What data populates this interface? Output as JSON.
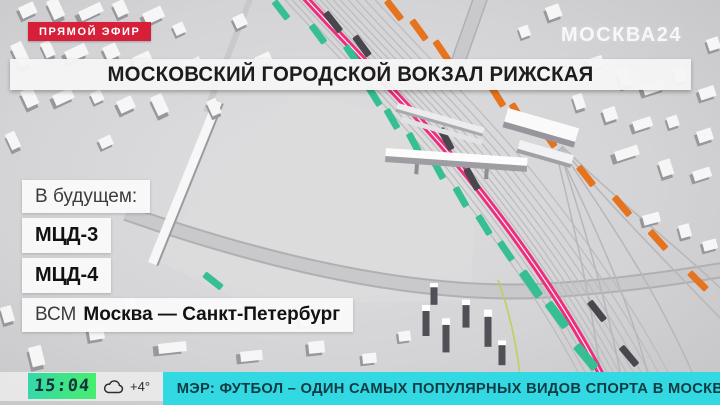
{
  "live_badge": {
    "label": "ПРЯМОЙ ЭФИР"
  },
  "channel": {
    "name": "МОСКВА24"
  },
  "headline": {
    "text": "МОСКОВСКИЙ ГОРОДСКОЙ ВОКЗАЛ РИЖСКАЯ"
  },
  "future": {
    "heading": "В будущем:",
    "items": [
      {
        "prefix": "",
        "name": "МЦД-3"
      },
      {
        "prefix": "",
        "name": "МЦД-4"
      },
      {
        "prefix": "ВСМ",
        "name": "Москва — Санкт-Петербург"
      }
    ]
  },
  "status_bar": {
    "time": "15:04",
    "temperature": "+4°",
    "ticker": "МЭР: ФУТБОЛ – ОДИН САМЫХ ПОПУЛЯРНЫХ ВИДОВ СПОРТА В МОСКВЕ"
  },
  "map": {
    "highlight_line_color": "#ee2d7c",
    "train_dash_green": "#36bf92",
    "train_dash_orange": "#e6731d",
    "train_dash_dark": "#47474d"
  },
  "colors": {
    "live_badge_bg": "#d6203a",
    "time_bg_green": "#47ee6e",
    "ticker_bg_cyan": "#32d8e2",
    "headline_bg": "#f5f5f5"
  }
}
